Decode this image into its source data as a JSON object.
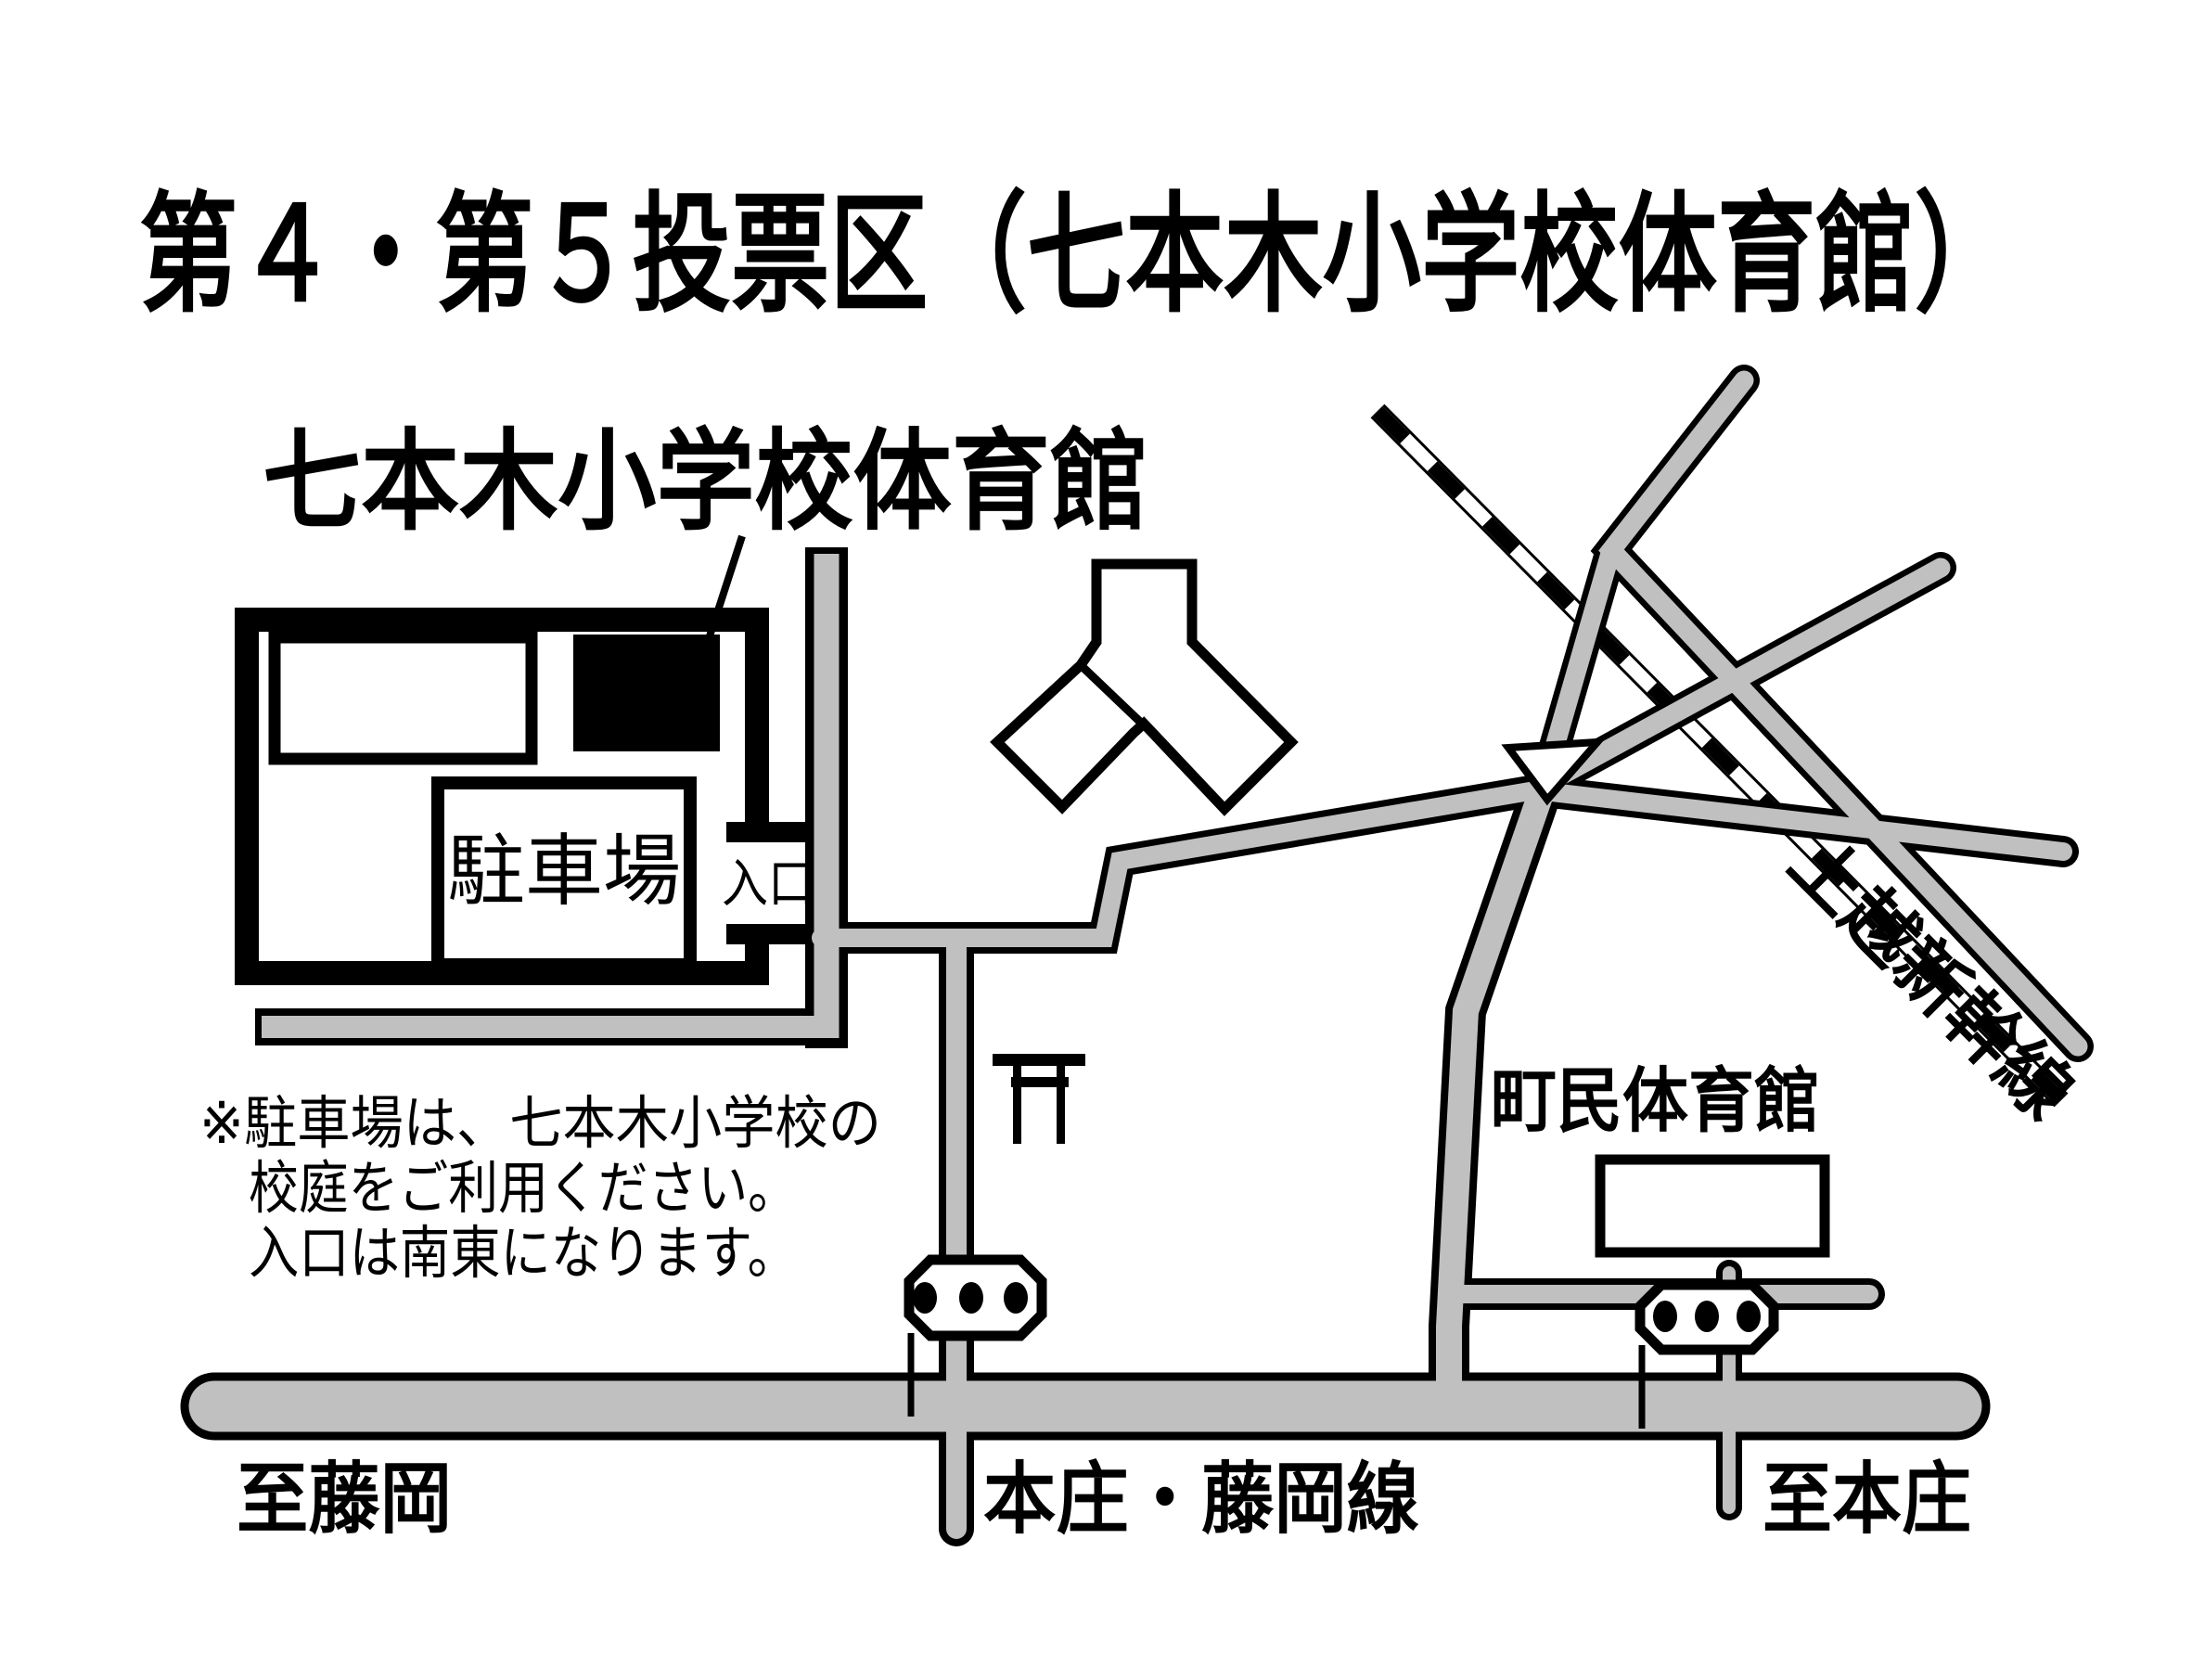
{
  "title": "第４・第５投票区（七本木小学校体育館）",
  "labels": {
    "school_gym": "七本木小学校体育館",
    "parking": "駐車場",
    "entrance": "入口",
    "town_gym": "町民体育館",
    "shinkansen": "上越新幹線",
    "to_fujioka": "至藤岡",
    "route_name": "本庄・藤岡線",
    "to_honjo": "至本庄"
  },
  "note": {
    "line1": "※駐車場は、七本木小学校の",
    "line2": "校庭をご利用ください。",
    "line3": "入口は南東になります。"
  },
  "legend": {
    "black_building_meaning": "七本木小学校体育館（投票所）",
    "gray_road_color": "#c0c0c0",
    "line_color": "#000000",
    "background_color": "#ffffff"
  }
}
